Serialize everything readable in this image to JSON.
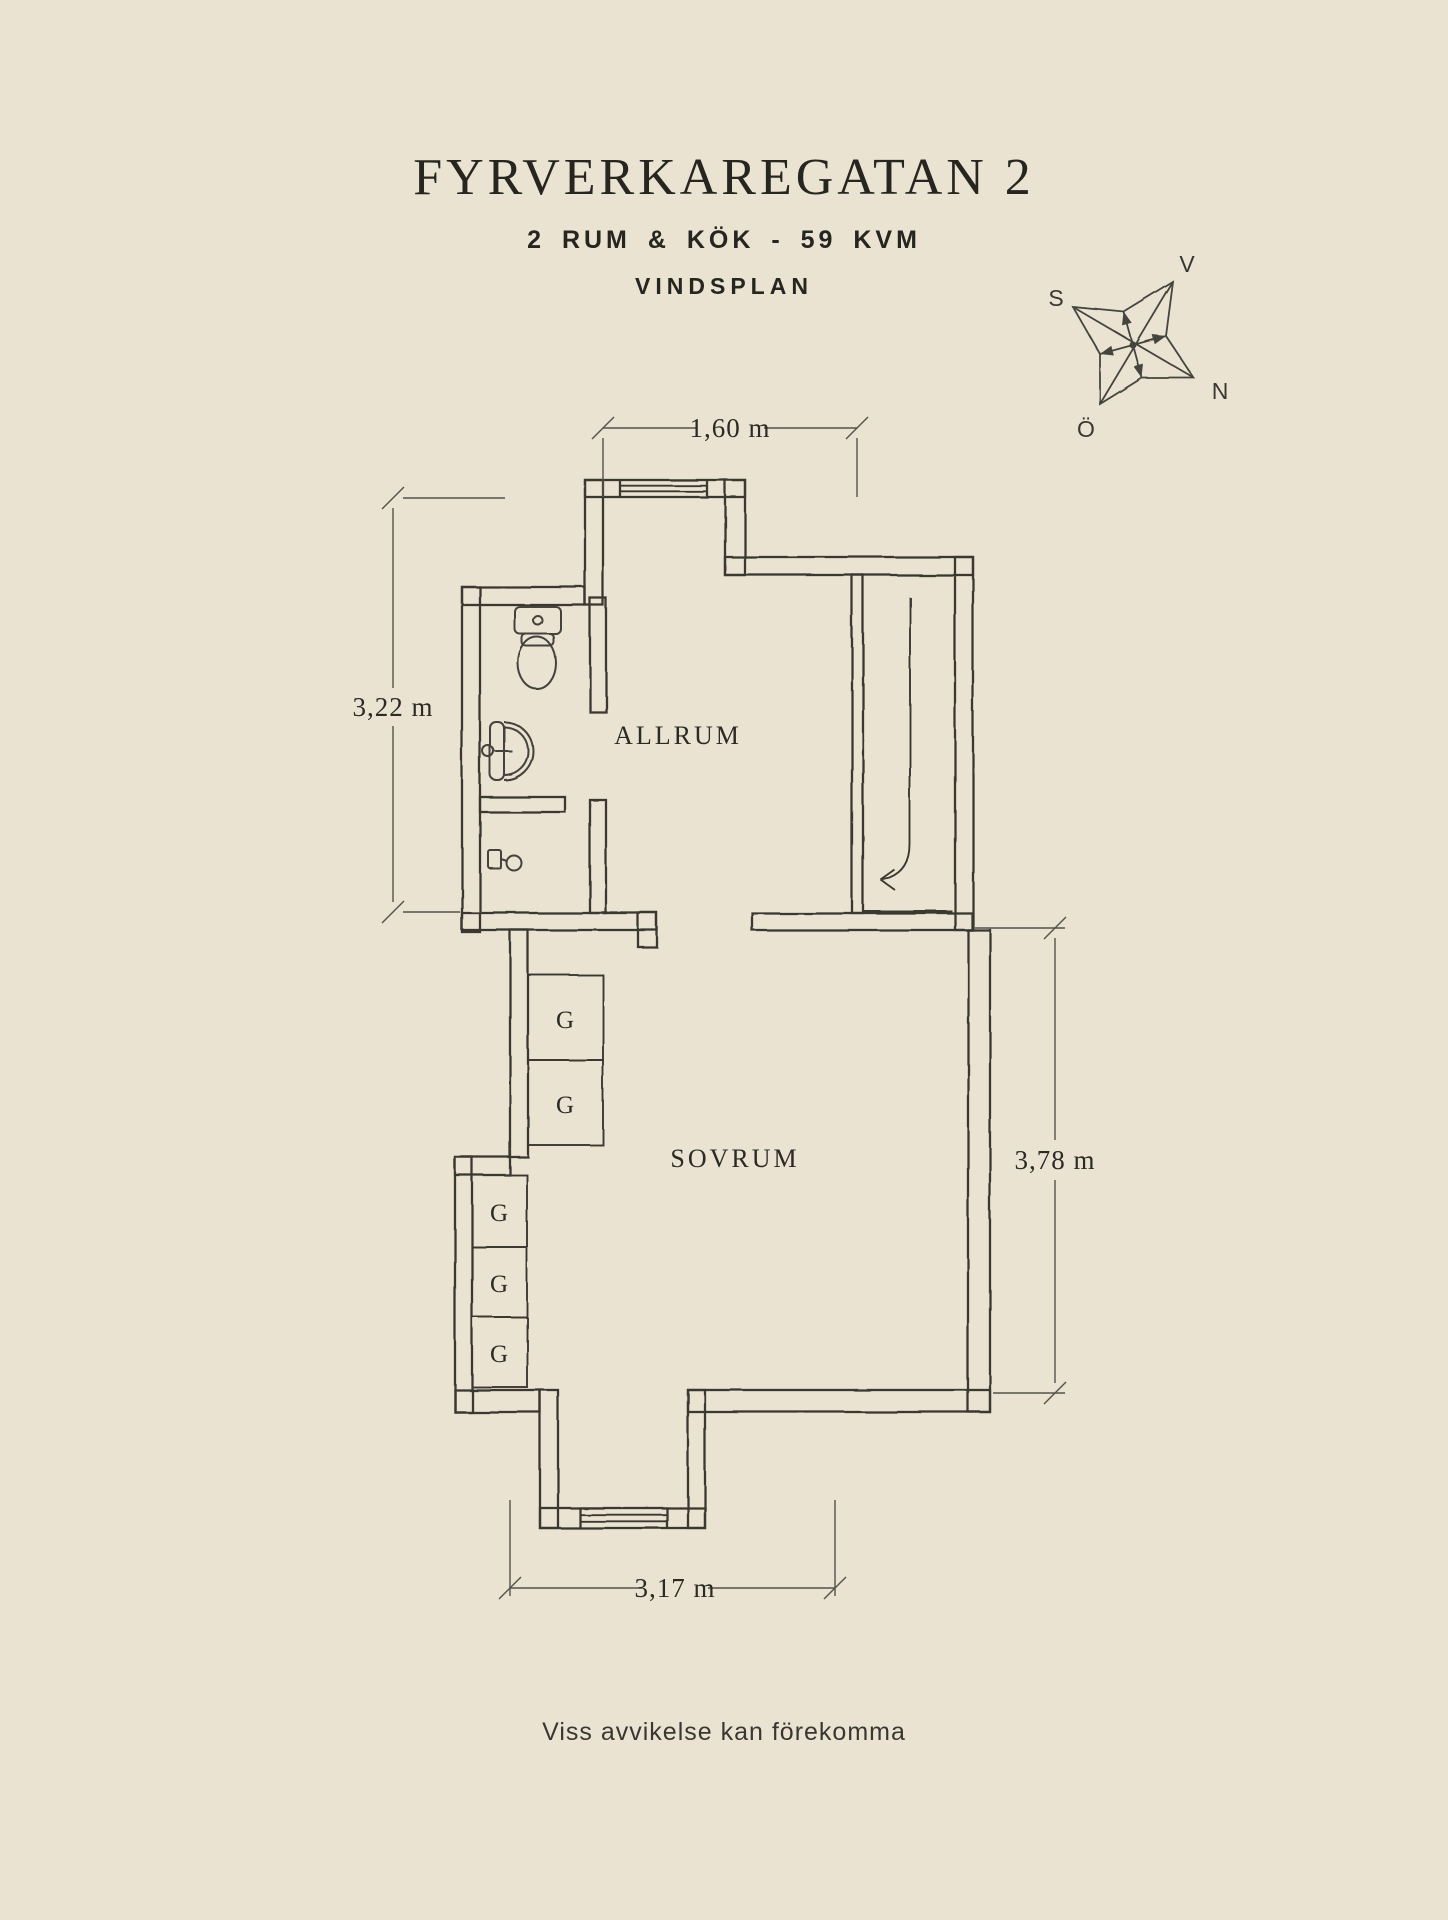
{
  "page": {
    "background": "#EAE3D2",
    "wall_color": "#3B3933",
    "dim_color": "#55524B",
    "text_color": "#26251F"
  },
  "header": {
    "title": "FYRVERKAREGATAN 2",
    "subtitle": "2 RUM & KÖK - 59 KVM",
    "plan_name": "VINDSPLAN"
  },
  "compass": {
    "west": "V",
    "south": "S",
    "north": "N",
    "east": "Ö"
  },
  "plan": {
    "rooms": {
      "allrum": "ALLRUM",
      "sovrum": "SOVRUM"
    },
    "closet_label": "G",
    "dimensions": {
      "top": "1,60 m",
      "left": "3,22 m",
      "right": "3,78 m",
      "bottom": "3,17 m"
    }
  },
  "footer": {
    "disclaimer": "Viss avvikelse kan förekomma"
  }
}
